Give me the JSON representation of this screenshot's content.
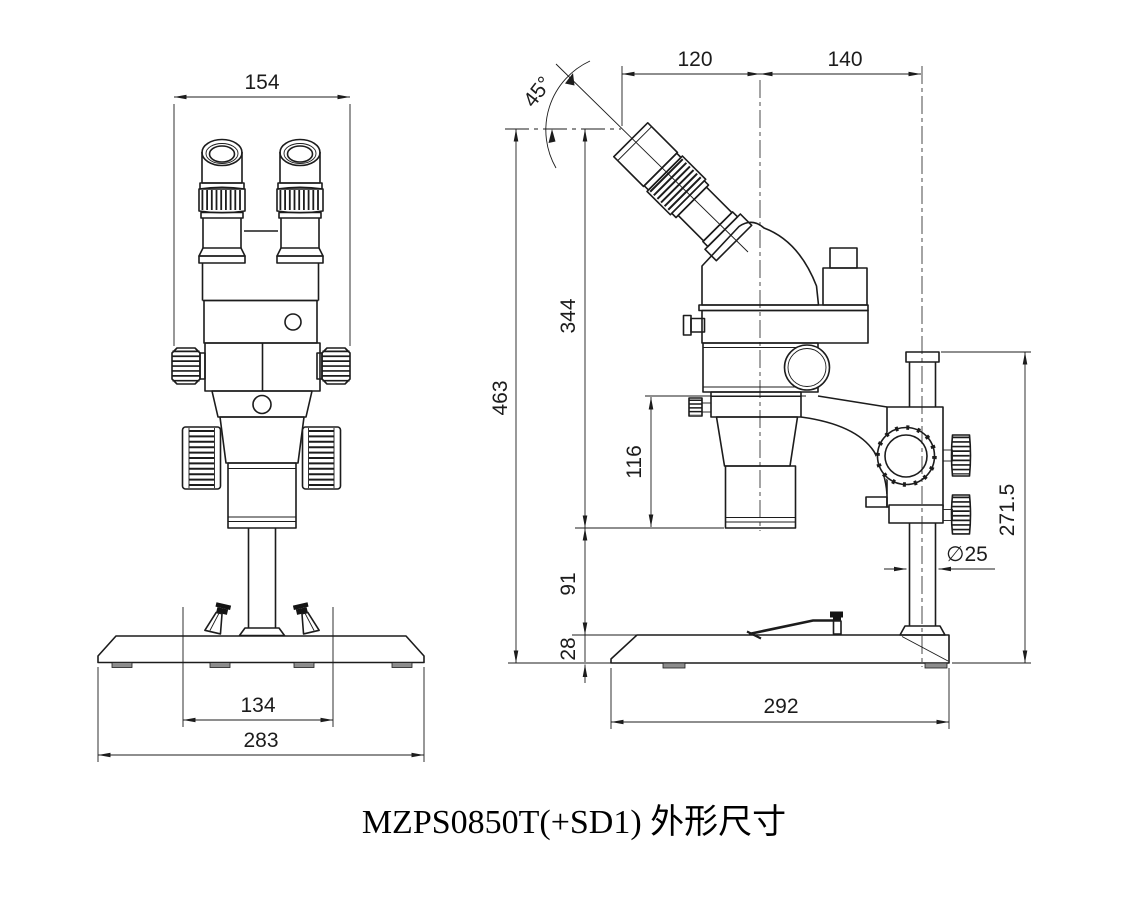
{
  "drawing": {
    "title": "MZPS0850T(+SD1) 外形尺寸",
    "line_color": "#1c1c1c",
    "background": "#ffffff",
    "front": {
      "dim_head_width": "154",
      "dim_inner_base": "134",
      "dim_base_width": "283"
    },
    "side": {
      "dim_angle": "45°",
      "dim_eyepiece_offset": "120",
      "dim_head_to_pillar": "140",
      "dim_total_height": "463",
      "dim_top_to_lens": "344",
      "dim_focus_travel": "116",
      "dim_lens_to_base": "91",
      "dim_base_height": "28",
      "dim_pillar_height": "271.5",
      "dim_pillar_dia": "∅25",
      "dim_base_depth": "292"
    }
  }
}
